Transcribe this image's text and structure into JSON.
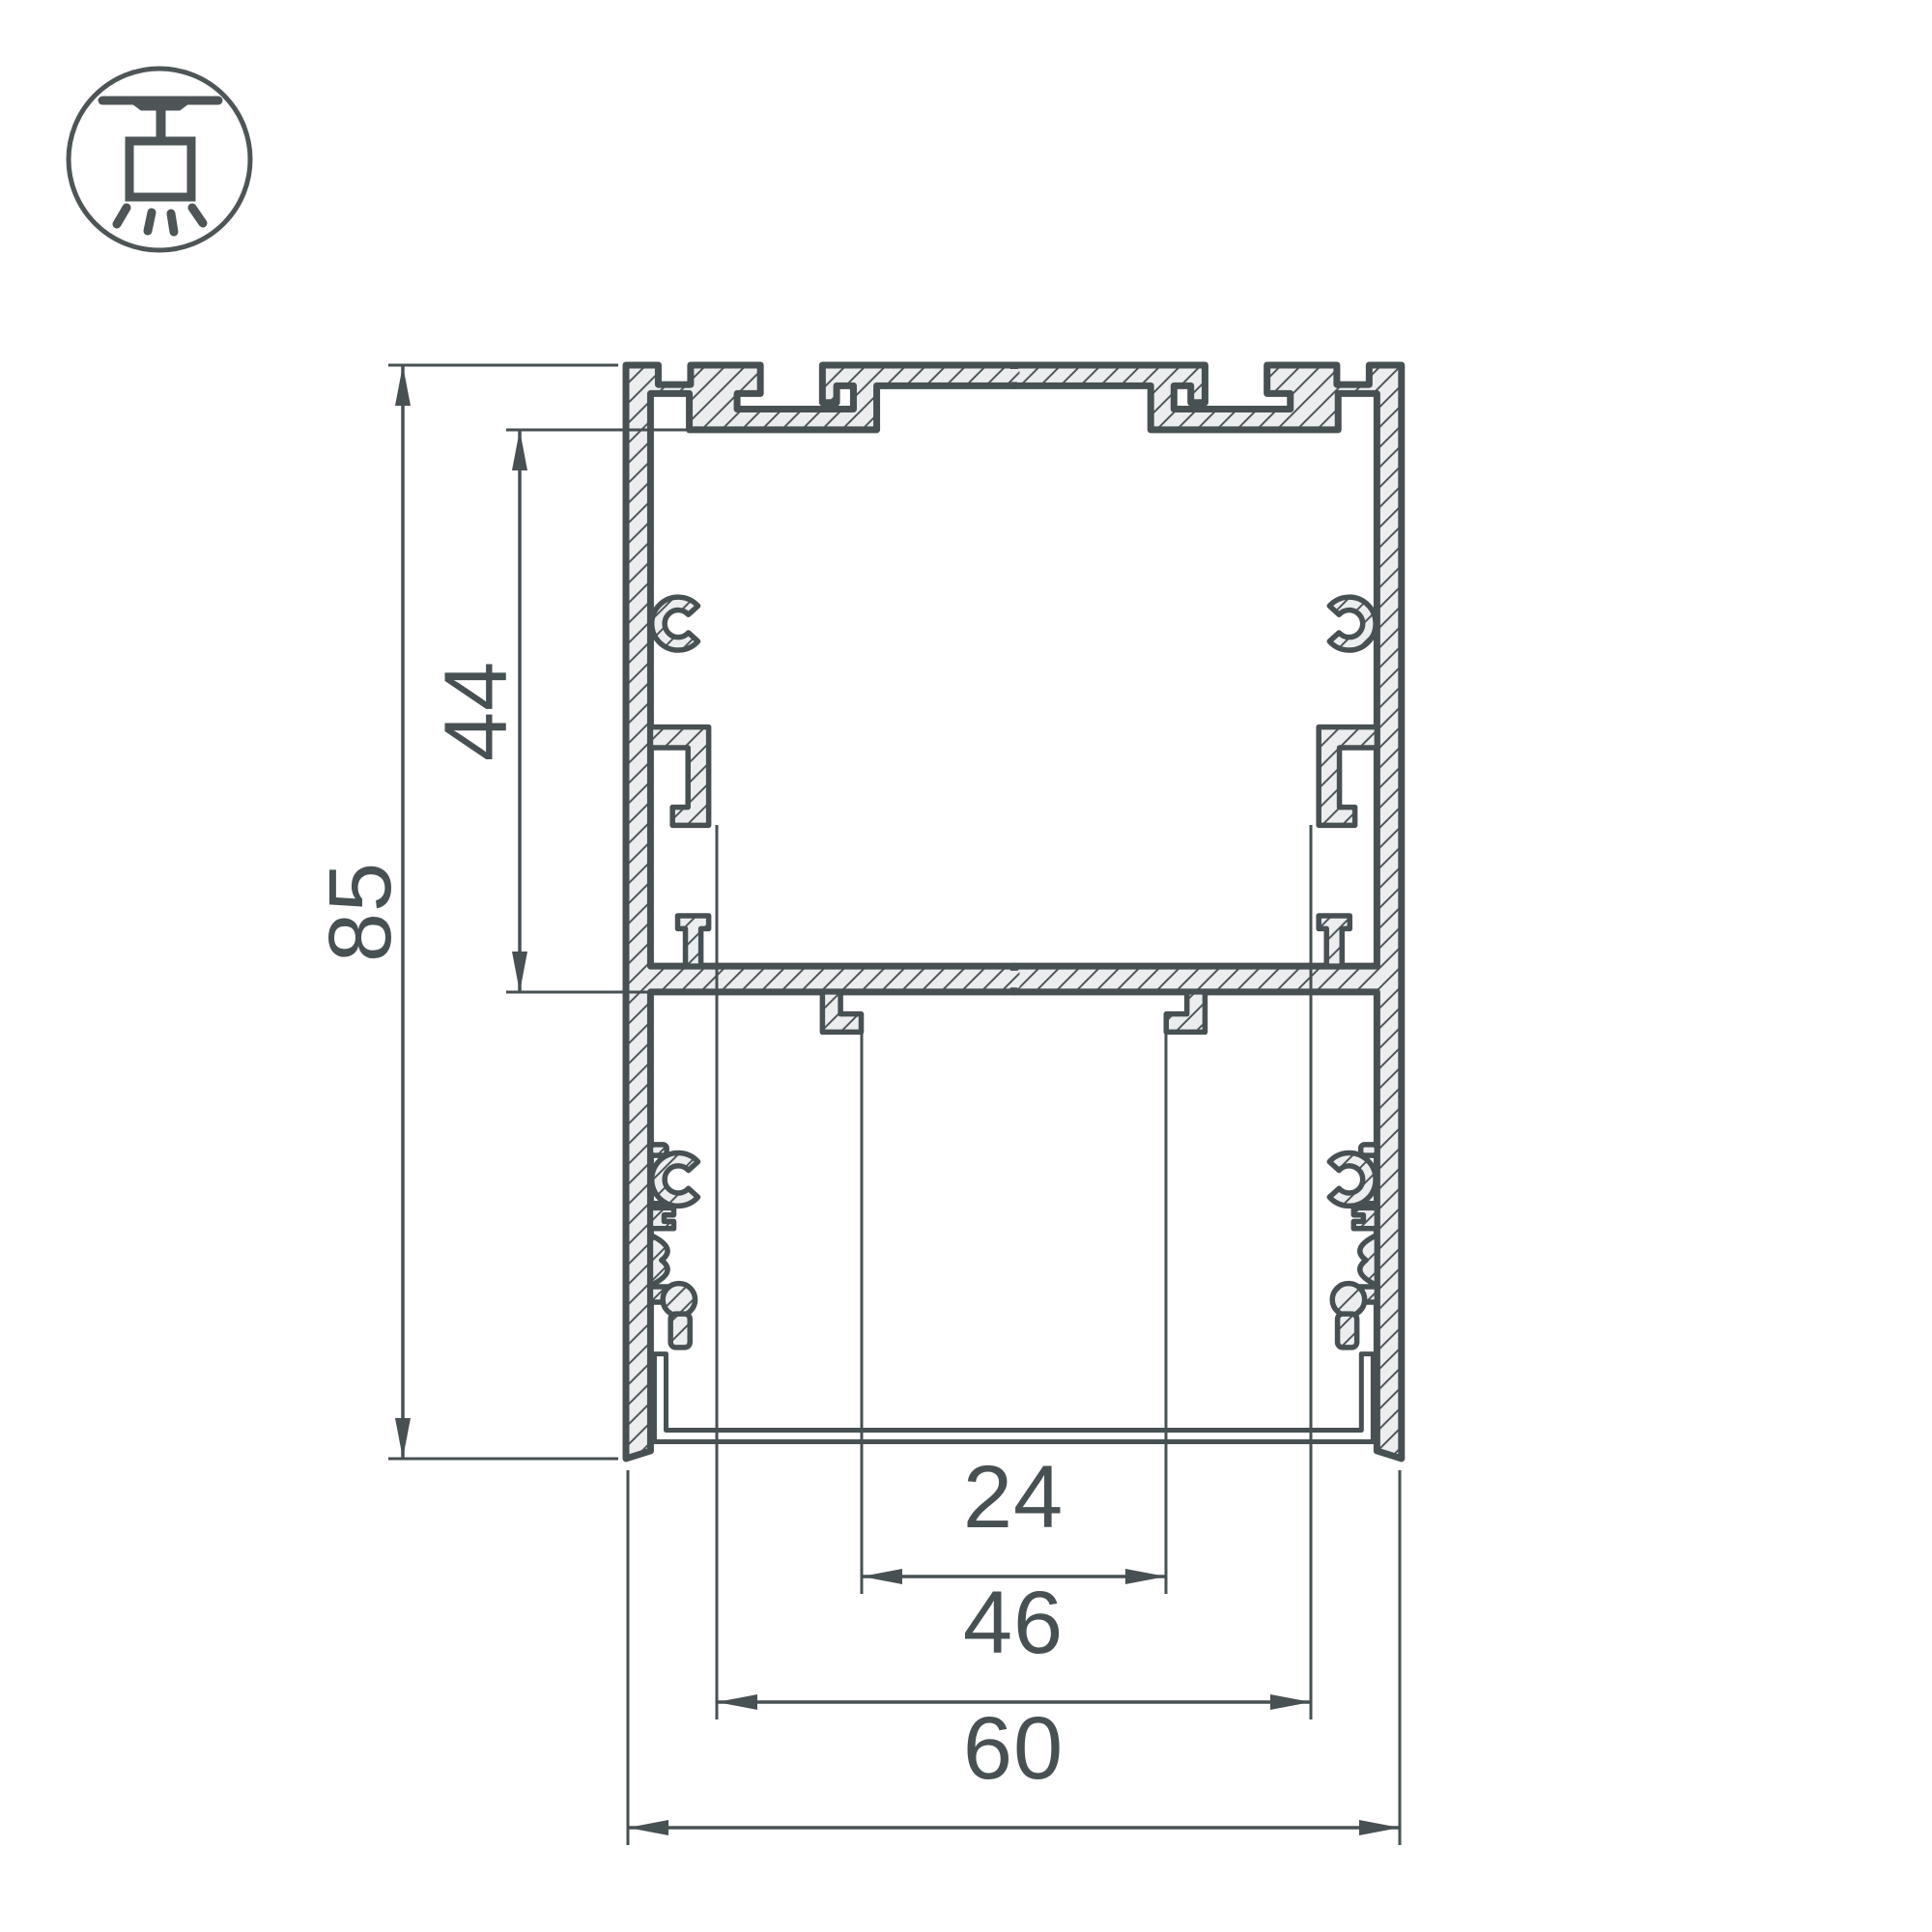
{
  "drawing": {
    "type": "technical-cross-section",
    "subject": "suspended aluminium LED profile",
    "profile": {
      "overall_width": 60,
      "overall_height": 85,
      "upper_chamber_height": 44,
      "led_channel_width": 24,
      "inner_slot_width": 46
    }
  },
  "dims": {
    "d85": {
      "label": "85",
      "orientation": "vertical"
    },
    "d44": {
      "label": "44",
      "orientation": "vertical"
    },
    "d24": {
      "label": "24",
      "orientation": "horizontal"
    },
    "d46": {
      "label": "46",
      "orientation": "horizontal"
    },
    "d60": {
      "label": "60",
      "orientation": "horizontal"
    }
  },
  "icon": {
    "name": "ceiling-pendant-mount",
    "description": "surface/pendant mounted luminaire symbol in circle"
  },
  "colors": {
    "line": "#475053",
    "material_fill": "#ebedee",
    "background": "#ffffff",
    "diffuser_fill": "#ffffff"
  }
}
